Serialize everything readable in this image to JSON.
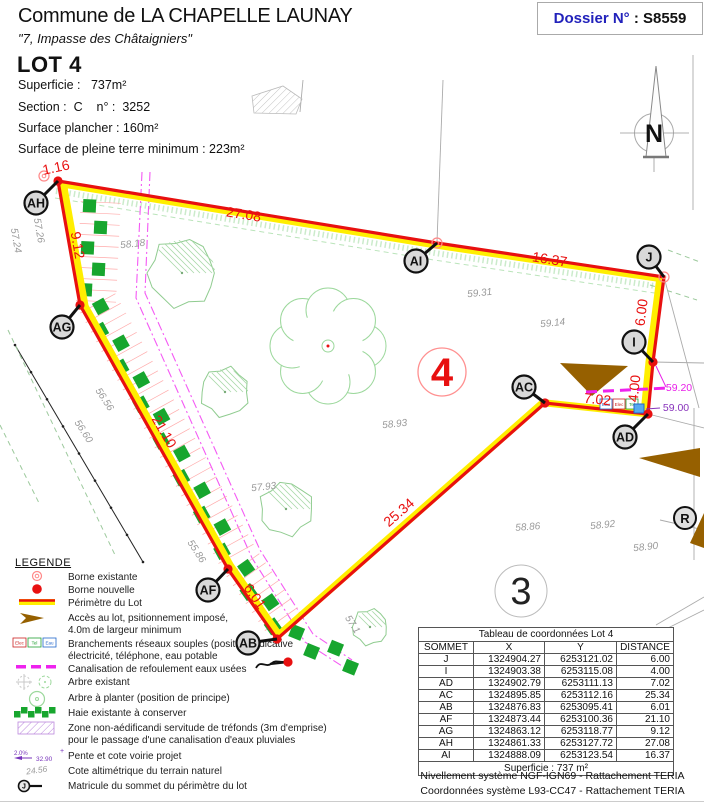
{
  "header": {
    "commune": "Commune de LA CHAPELLE LAUNAY",
    "address": "\"7, Impasse des Châtaigniers\"",
    "dossier_prefix": "Dossier N°",
    "dossier_suffix": " : S8559",
    "lot_title": "LOT 4",
    "info_lines": [
      "Superficie :   737m²",
      "Section :  C    n° :  3252",
      "Surface plancher : 160m²",
      "Surface de pleine terre minimum : 223m²"
    ],
    "north_label": "N"
  },
  "colors": {
    "perimeter_red": "#e81010",
    "perimeter_yellow": "#ffee00",
    "hedge_green": "#17a62e",
    "tree_green": "#9cd89c",
    "access_brown": "#966000",
    "pipe_magenta": "#ee22ee",
    "servitude_magenta": "#f23cf2",
    "dossier_blue": "#2222bb",
    "label_fill": "#d9d9d9",
    "elevation_gray": "#9a9a9a",
    "parcel_gray": "#ababab",
    "zone_purple": "#bb88dd",
    "pente_purple": "#7733bb"
  },
  "plan": {
    "lot_number": "4",
    "adjacent_lot": "3",
    "road_label": "R",
    "perimeter_order": [
      "AH",
      "AI",
      "J",
      "I",
      "AD",
      "AC",
      "AB",
      "AF",
      "AG"
    ],
    "vertices": [
      {
        "id": "AH",
        "dot": [
          58,
          181
        ],
        "label": [
          36,
          203
        ],
        "type": "new"
      },
      {
        "id": "AG",
        "dot": [
          80,
          305
        ],
        "label": [
          62,
          327
        ],
        "type": "new"
      },
      {
        "id": "AF",
        "dot": [
          228,
          569
        ],
        "label": [
          208,
          590
        ],
        "type": "new"
      },
      {
        "id": "AB",
        "dot": [
          277,
          639
        ],
        "label": [
          248,
          643
        ],
        "type": "new"
      },
      {
        "id": "AC",
        "dot": [
          545,
          403
        ],
        "label": [
          524,
          387
        ],
        "type": "new"
      },
      {
        "id": "AD",
        "dot": [
          648,
          414
        ],
        "label": [
          625,
          437
        ],
        "type": "new"
      },
      {
        "id": "I",
        "dot": [
          653,
          362
        ],
        "label": [
          634,
          342
        ],
        "type": "new"
      },
      {
        "id": "J",
        "dot": [
          664,
          277
        ],
        "label": [
          649,
          257
        ],
        "type": "existing"
      },
      {
        "id": "AI",
        "dot": [
          437,
          243
        ],
        "label": [
          416,
          261
        ],
        "type": "existing"
      }
    ],
    "extra_new_borne": [
      288,
      662
    ],
    "extra_existing_borne": [
      44,
      176
    ],
    "distances": [
      {
        "t": "1.16",
        "x": 57,
        "y": 172,
        "r": -12
      },
      {
        "t": "27.08",
        "x": 243,
        "y": 219,
        "r": 9
      },
      {
        "t": "16.37",
        "x": 549,
        "y": 264,
        "r": 9
      },
      {
        "t": "6.00",
        "x": 646,
        "y": 313,
        "r": -83
      },
      {
        "t": "4.00",
        "x": 639,
        "y": 389,
        "r": -84
      },
      {
        "t": "7.02",
        "x": 597,
        "y": 404,
        "r": 6
      },
      {
        "t": "25.34",
        "x": 402,
        "y": 516,
        "r": -41
      },
      {
        "t": "6.01",
        "x": 251,
        "y": 599,
        "r": 55
      },
      {
        "t": "21.10",
        "x": 160,
        "y": 434,
        "r": 60
      },
      {
        "t": "9.12",
        "x": 73,
        "y": 246,
        "r": 80
      }
    ],
    "elevations": [
      {
        "t": "58.18",
        "x": 133,
        "y": 247,
        "r": -6
      },
      {
        "t": "59.31",
        "x": 480,
        "y": 296,
        "r": -6
      },
      {
        "t": "59.14",
        "x": 553,
        "y": 326,
        "r": -6
      },
      {
        "t": "58.93",
        "x": 395,
        "y": 427,
        "r": -6
      },
      {
        "t": "57.93",
        "x": 264,
        "y": 490,
        "r": -6
      },
      {
        "t": "58.86",
        "x": 528,
        "y": 530,
        "r": -4
      },
      {
        "t": "58.92",
        "x": 603,
        "y": 528,
        "r": -6
      },
      {
        "t": "58.90",
        "x": 646,
        "y": 550,
        "r": -6
      },
      {
        "t": "57.26",
        "x": 36,
        "y": 231,
        "r": 80
      },
      {
        "t": "57.24",
        "x": 13,
        "y": 241,
        "r": 80
      },
      {
        "t": "56.56",
        "x": 102,
        "y": 401,
        "r": 57
      },
      {
        "t": "56.60",
        "x": 81,
        "y": 433,
        "r": 57
      },
      {
        "t": "55.86",
        "x": 194,
        "y": 553,
        "r": 57
      },
      {
        "t": "57.1",
        "x": 350,
        "y": 626,
        "r": 57
      }
    ],
    "annotations": [
      {
        "text": "59.20",
        "x": 679,
        "y": 391,
        "color": "#e820e8",
        "leader": [
          [
            656,
            366
          ],
          [
            666,
            387
          ]
        ]
      },
      {
        "text": "59.00",
        "x": 676,
        "y": 411,
        "color": "#8833bb",
        "leader": [
          [
            646,
            409
          ],
          [
            660,
            408
          ]
        ]
      }
    ],
    "utility_boxes": {
      "x": 600,
      "y": 399,
      "items": [
        {
          "label": "Eau",
          "color": "#2266cc"
        },
        {
          "label": "Elec",
          "color": "#cc2222"
        },
        {
          "label": "Tel",
          "color": "#22a033"
        }
      ]
    },
    "water_point": [
      634,
      404
    ],
    "canal_line": [
      [
        586,
        392
      ],
      [
        668,
        388
      ]
    ],
    "hedge_path": [
      [
        93,
        196
      ],
      [
        88,
        302
      ],
      [
        233,
        565
      ],
      [
        284,
        637
      ],
      [
        358,
        667
      ]
    ],
    "servitude_lines": [
      [
        [
          142,
          172
        ],
        [
          136,
          298
        ],
        [
          252,
          558
        ],
        [
          305,
          642
        ],
        [
          345,
          668
        ]
      ],
      [
        [
          150,
          172
        ],
        [
          145,
          293
        ],
        [
          260,
          550
        ],
        [
          313,
          634
        ],
        [
          352,
          660
        ]
      ]
    ],
    "fence_line": [
      [
        15,
        345
      ],
      [
        143,
        562
      ]
    ],
    "green_dash_lines": [
      [
        [
          8,
          330
        ],
        [
          115,
          555
        ]
      ],
      [
        [
          0,
          425
        ],
        [
          40,
          505
        ]
      ],
      [
        [
          668,
          250
        ],
        [
          700,
          262
        ]
      ],
      [
        [
          650,
          285
        ],
        [
          697,
          300
        ]
      ]
    ],
    "parcel_lines": [
      [
        [
          443,
          80
        ],
        [
          437,
          242
        ]
      ],
      [
        [
          303,
          80
        ],
        [
          300,
          112
        ]
      ],
      [
        [
          693,
          55
        ],
        [
          693,
          210
        ]
      ],
      [
        [
          664,
          277
        ],
        [
          699,
          408
        ]
      ],
      [
        [
          653,
          362
        ],
        [
          704,
          363
        ]
      ],
      [
        [
          648,
          414
        ],
        [
          704,
          428
        ]
      ],
      [
        [
          660,
          520
        ],
        [
          704,
          530
        ]
      ],
      [
        [
          656,
          625
        ],
        [
          704,
          597
        ]
      ],
      [
        [
          668,
          628
        ],
        [
          704,
          610
        ]
      ],
      [
        [
          694,
          408
        ],
        [
          694,
          560
        ]
      ]
    ],
    "hatched_quad": [
      [
        252,
        96
      ],
      [
        283,
        86
      ],
      [
        302,
        99
      ],
      [
        296,
        114
      ],
      [
        254,
        113
      ]
    ],
    "access_triangles": [
      [
        [
          560,
          363
        ],
        [
          628,
          366
        ],
        [
          592,
          396
        ]
      ],
      [
        [
          639,
          458
        ],
        [
          700,
          448
        ],
        [
          700,
          477
        ]
      ],
      [
        [
          690,
          543
        ],
        [
          704,
          513
        ],
        [
          704,
          548
        ]
      ]
    ],
    "trees": [
      {
        "cx": 182,
        "cy": 273,
        "r": 36
      },
      {
        "cx": 225,
        "cy": 392,
        "r": 26
      },
      {
        "cx": 286,
        "cy": 509,
        "r": 28
      },
      {
        "cx": 370,
        "cy": 627,
        "r": 19
      }
    ],
    "flower_tree": {
      "cx": 328,
      "cy": 346,
      "r": 54
    },
    "lot_circle": {
      "cx": 442,
      "cy": 372,
      "r": 24
    },
    "adj_circle": {
      "cx": 521,
      "cy": 591,
      "r": 26
    },
    "road_circle": {
      "cx": 685,
      "cy": 518,
      "r": 11
    }
  },
  "legend": {
    "title": "LEGENDE",
    "items": [
      {
        "symbol": "borne-existante",
        "y": 572,
        "lines": [
          "Borne existante"
        ]
      },
      {
        "symbol": "borne-nouvelle",
        "y": 585,
        "lines": [
          "Borne nouvelle"
        ]
      },
      {
        "symbol": "perimetre",
        "y": 598,
        "lines": [
          "Périmètre du Lot"
        ]
      },
      {
        "symbol": "acces",
        "y": 613,
        "lines": [
          "Accès au lot, psitionnement imposé,",
          "4.0m de largeur minimum"
        ]
      },
      {
        "symbol": "branchements",
        "y": 639,
        "lines": [
          "Branchements réseaux souples (position indicative",
          "électricité, téléphone, eau potable"
        ]
      },
      {
        "symbol": "canalisation",
        "y": 664,
        "lines": [
          "Canalisation de refoulement eaux usées"
        ]
      },
      {
        "symbol": "arbre-existant",
        "y": 677,
        "lines": [
          "Arbre existant"
        ]
      },
      {
        "symbol": "arbre-a-planter",
        "y": 693,
        "lines": [
          "Arbre à planter (position de principe)"
        ]
      },
      {
        "symbol": "haie",
        "y": 708,
        "lines": [
          "Haie existante à conserver"
        ]
      },
      {
        "symbol": "zone",
        "y": 723,
        "lines": [
          "Zone non-aédificandi servitude de tréfonds (3m d'emprise)",
          "pour le passage d'une canalisation d'eaux pluviales"
        ]
      },
      {
        "symbol": "pente",
        "y": 751,
        "lines": [
          "Pente et cote voirie projet"
        ]
      },
      {
        "symbol": "cote",
        "y": 766,
        "lines": [
          "Cote altimétrique du terrain naturel"
        ]
      },
      {
        "symbol": "matricule",
        "y": 781,
        "lines": [
          "Matricule du sommet du périmètre du lot"
        ]
      }
    ],
    "branchement_boxes": [
      {
        "label": "Elec",
        "color": "#cc2222"
      },
      {
        "label": "Tel",
        "color": "#22a033"
      },
      {
        "label": "Eau",
        "color": "#2266cc"
      }
    ],
    "pente_values": [
      "2.0%",
      "32.90"
    ],
    "cote_value": "24.56",
    "matricule_letter": "J"
  },
  "table": {
    "title": "Tableau de coordonnées Lot 4",
    "headers": [
      "SOMMET",
      "X",
      "Y",
      "DISTANCE"
    ],
    "rows": [
      [
        "J",
        "1324904.27",
        "6253121.02",
        "6.00"
      ],
      [
        "I",
        "1324903.38",
        "6253115.08",
        "4.00"
      ],
      [
        "AD",
        "1324902.79",
        "6253111.13",
        "7.02"
      ],
      [
        "AC",
        "1324895.85",
        "6253112.16",
        "25.34"
      ],
      [
        "AB",
        "1324876.83",
        "6253095.41",
        "6.01"
      ],
      [
        "AF",
        "1324873.44",
        "6253100.36",
        "21.10"
      ],
      [
        "AG",
        "1324863.12",
        "6253118.77",
        "9.12"
      ],
      [
        "AH",
        "1324861.33",
        "6253127.72",
        "27.08"
      ],
      [
        "AI",
        "1324888.09",
        "6253123.54",
        "16.37"
      ]
    ],
    "footer": "Superficie : 737 m²"
  },
  "footnotes": [
    "Nivellement système NGF-IGN69 - Rattachement TERIA",
    "Coordonnées système L93-CC47  - Rattachement TERIA"
  ]
}
